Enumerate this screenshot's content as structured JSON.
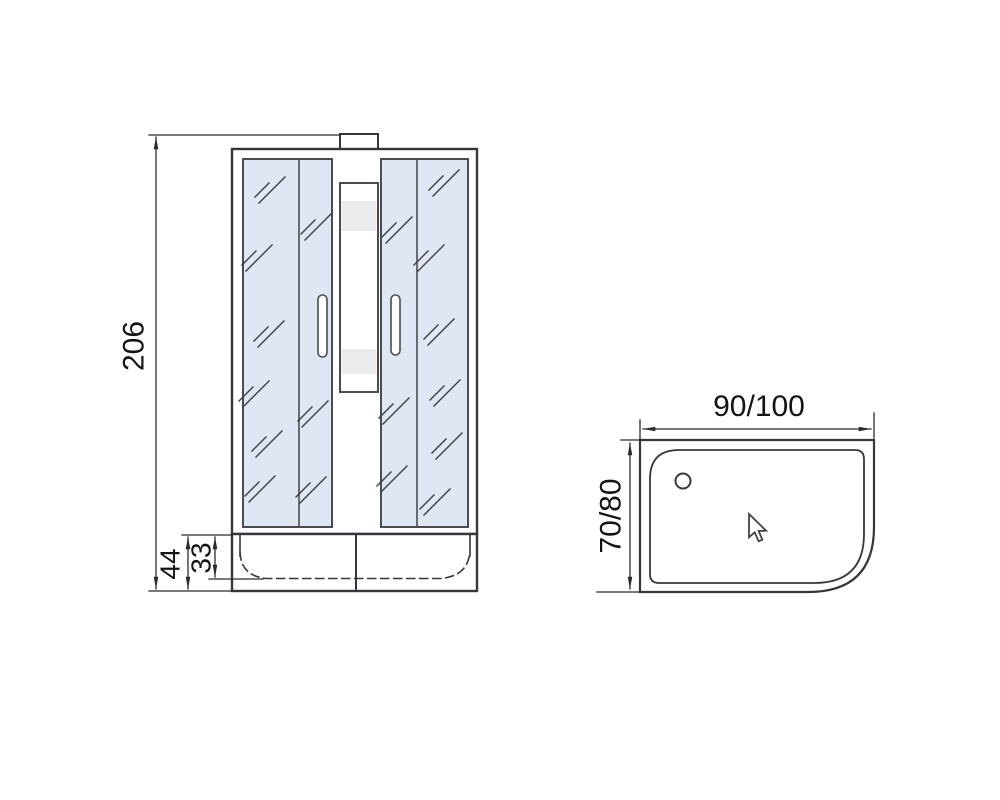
{
  "page": {
    "background": "#ffffff"
  },
  "drawing": {
    "colors": {
      "outline": "#35373a",
      "dimension_line": "#2b2b2b",
      "glass_fill": "#dfe7f4",
      "panel_band": "#ebebee",
      "paper": "#ffffff"
    },
    "front_view": {
      "dimensions": {
        "overall_height": "206",
        "tray_total_height": "44",
        "tray_inner_depth": "33"
      }
    },
    "top_view": {
      "dimensions": {
        "width": "90/100",
        "depth": "70/80"
      }
    },
    "icons": {
      "cursor": "arrow-cursor-icon",
      "drain": "drain-hole-icon"
    }
  }
}
